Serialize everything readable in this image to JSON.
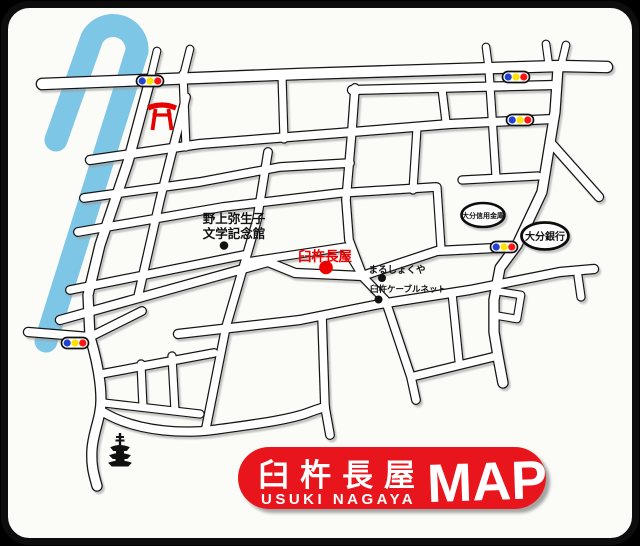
{
  "badge": {
    "name_jp": "臼杵長屋",
    "name_en": "USUKI NAGAYA",
    "suffix": "MAP"
  },
  "pois": {
    "memorial": {
      "line1": "野上弥生子",
      "line2": "文学記念館"
    },
    "usuki_nagaya": {
      "label": "臼杵長屋"
    },
    "marushokuya": {
      "label": "まるしょくや"
    },
    "cablenet": {
      "label": "臼杵ケーブルネット"
    }
  },
  "banks": {
    "shinkin": {
      "label": "大分信用金庫"
    },
    "oita": {
      "label": "大分銀行"
    }
  },
  "colors": {
    "badge_red": "#e8151e",
    "map_label_red": "#ee0000",
    "river_blue": "#7ec6e6",
    "torii_red": "#e60000",
    "traffic_blue": "#2343cf",
    "traffic_yellow": "#ffe400",
    "traffic_red": "#ff1414",
    "road_casing": "#161616",
    "card_bg": "#fbfbf8"
  }
}
